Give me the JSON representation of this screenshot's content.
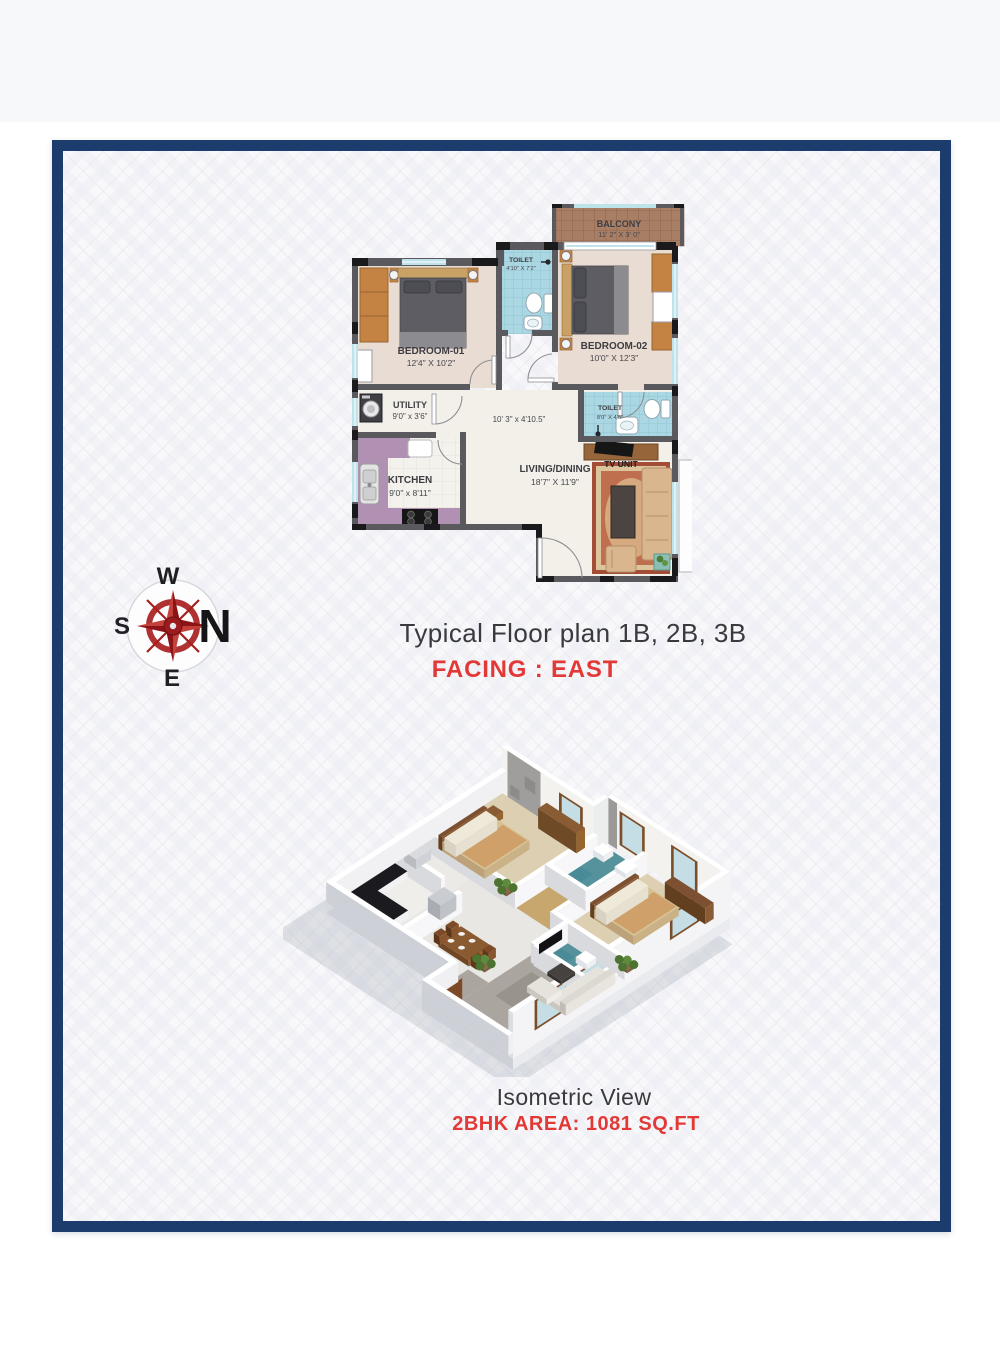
{
  "titles": {
    "plan_title": "Typical Floor plan  1B, 2B, 3B",
    "facing": "FACING : EAST",
    "iso_title": "Isometric View",
    "iso_area": "2BHK AREA: 1081 SQ.FT"
  },
  "compass": {
    "n": "N",
    "s": "S",
    "e": "E",
    "w": "W"
  },
  "floorplan": {
    "balcony": {
      "name": "BALCONY",
      "dims": "11' 2\" X 3' 0\""
    },
    "toilet1": {
      "name": "TOILET",
      "dims": "4'10\" X 7'2\""
    },
    "bedroom1": {
      "name": "BEDROOM-01",
      "dims": "12'4\" X 10'2\""
    },
    "bedroom2": {
      "name": "BEDROOM-02",
      "dims": "10'0\" X 12'3\""
    },
    "utility": {
      "name": "UTILITY",
      "dims": "9'0\" x 3'6\""
    },
    "kitchen": {
      "name": "KITCHEN",
      "dims": "9'0\" x 8'11\""
    },
    "living": {
      "name": "LIVING/DINING",
      "dims": "18'7\" X 11'9\""
    },
    "toilet2": {
      "name": "TOILET",
      "dims": "8'0\" X 4'6\""
    },
    "tv_unit": {
      "name": "TV UNIT"
    },
    "passage": {
      "dims": "10' 3\" x 4'10.5\""
    }
  },
  "colors": {
    "accent_red": "#e23937",
    "frame_navy": "#1b3c6c"
  }
}
